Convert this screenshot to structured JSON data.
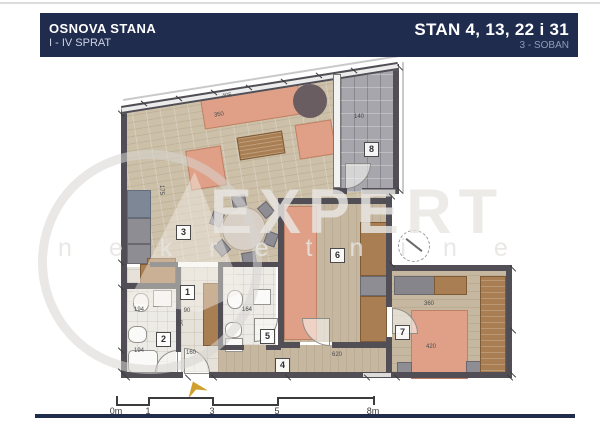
{
  "header": {
    "title": "OSNOVA STANA",
    "subtitle": "I - IV SPRAT",
    "unit_title": "STAN 4, 13, 22 i 31",
    "unit_type": "3 - SOBAN"
  },
  "watermark": {
    "brand": "EXPERT",
    "subtitle": "nekretnine"
  },
  "rooms": [
    {
      "num": "1"
    },
    {
      "num": "2"
    },
    {
      "num": "3"
    },
    {
      "num": "4"
    },
    {
      "num": "5"
    },
    {
      "num": "6"
    },
    {
      "num": "7"
    },
    {
      "num": "8"
    }
  ],
  "dimensions": [
    {
      "t": "405",
      "x": 227,
      "y": 96,
      "r": -9
    },
    {
      "t": "350",
      "x": 219,
      "y": 115,
      "r": -9
    },
    {
      "t": "140",
      "x": 359,
      "y": 117,
      "r": 0
    },
    {
      "t": "175",
      "x": 161,
      "y": 190,
      "r": 90
    },
    {
      "t": "194",
      "x": 139,
      "y": 310,
      "r": 0
    },
    {
      "t": "194",
      "x": 139,
      "y": 351,
      "r": 0
    },
    {
      "t": "85",
      "x": 179,
      "y": 323,
      "r": 90
    },
    {
      "t": "90",
      "x": 187,
      "y": 311,
      "r": 0
    },
    {
      "t": "160",
      "x": 191,
      "y": 353,
      "r": 0
    },
    {
      "t": "164",
      "x": 247,
      "y": 310,
      "r": 0
    },
    {
      "t": "620",
      "x": 337,
      "y": 355,
      "r": 0
    },
    {
      "t": "360",
      "x": 429,
      "y": 304,
      "r": 0
    },
    {
      "t": "420",
      "x": 431,
      "y": 347,
      "r": 0
    }
  ],
  "ticks": [
    {
      "x": 140,
      "y": 103,
      "r": 40
    },
    {
      "x": 175,
      "y": 98,
      "r": 40
    },
    {
      "x": 210,
      "y": 92,
      "r": 40
    },
    {
      "x": 245,
      "y": 87,
      "r": 40
    },
    {
      "x": 280,
      "y": 81,
      "r": 40
    },
    {
      "x": 315,
      "y": 75,
      "r": 40
    },
    {
      "x": 350,
      "y": 70,
      "r": 40
    },
    {
      "x": 117,
      "y": 113,
      "r": 45
    },
    {
      "x": 117,
      "y": 262,
      "r": 45
    },
    {
      "x": 117,
      "y": 287,
      "r": 45
    },
    {
      "x": 117,
      "y": 350,
      "r": 45
    },
    {
      "x": 117,
      "y": 371,
      "r": 45
    },
    {
      "x": 123,
      "y": 377,
      "r": 45
    },
    {
      "x": 184,
      "y": 377,
      "r": 45
    },
    {
      "x": 210,
      "y": 377,
      "r": 45
    },
    {
      "x": 284,
      "y": 377,
      "r": 45
    },
    {
      "x": 363,
      "y": 377,
      "r": 45
    },
    {
      "x": 393,
      "y": 377,
      "r": 45
    },
    {
      "x": 506,
      "y": 377,
      "r": 45
    },
    {
      "x": 509,
      "y": 268,
      "r": 45
    },
    {
      "x": 509,
      "y": 330,
      "r": 45
    },
    {
      "x": 509,
      "y": 374,
      "r": 45
    },
    {
      "x": 396,
      "y": 67,
      "r": 45
    },
    {
      "x": 396,
      "y": 190,
      "r": 45
    },
    {
      "x": 388,
      "y": 196,
      "r": 45
    },
    {
      "x": 388,
      "y": 264,
      "r": 45
    }
  ],
  "scalebar": {
    "labels": [
      {
        "t": "0m",
        "x": 0
      },
      {
        "t": "1",
        "x": 32
      },
      {
        "t": "3",
        "x": 96
      },
      {
        "t": "5",
        "x": 161
      },
      {
        "t": "8m",
        "x": 257
      }
    ]
  },
  "colors": {
    "navy": "#202c4e",
    "wall": "#514f55",
    "salmon": "#dfa087",
    "brown": "#a87e52",
    "gold": "#d1a02c",
    "terrace_gray": "#a6a6ac"
  }
}
